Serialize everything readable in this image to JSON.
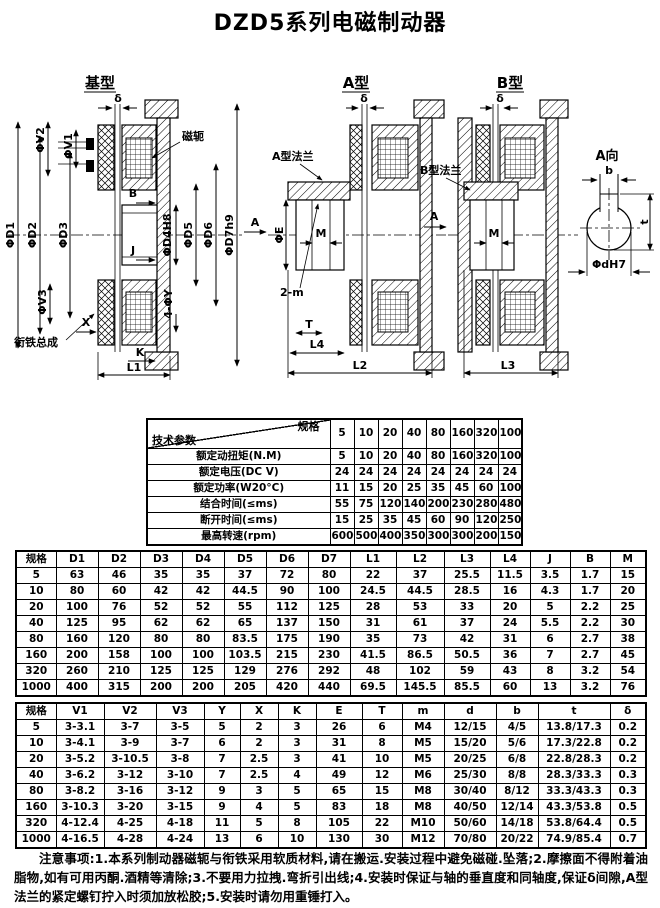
{
  "title": "DZD5系列电磁制动器",
  "diagrams": {
    "base": {
      "title": "基型",
      "delta": "δ",
      "yoke": "磁轭",
      "armature": "衔铁总成",
      "v1": "ΦV1",
      "v2": "ΦV2",
      "v3": "ΦV3",
      "d1": "ΦD1",
      "d2": "ΦD2",
      "d3": "ΦD3",
      "d4": "ΦD4H8",
      "d5": "ΦD5",
      "d6": "ΦD6",
      "d7": "ΦD7h9",
      "b": "B",
      "j": "J",
      "four_y": "4-ΦY",
      "x": "X",
      "k": "K",
      "l1": "L1"
    },
    "typeA": {
      "title": "A型",
      "delta": "δ",
      "flange": "A型法兰",
      "e": "ΦE",
      "m": "M",
      "a": "A",
      "two_m": "2-m",
      "t": "T",
      "l4": "L4",
      "l2": "L2"
    },
    "typeB": {
      "title": "B型",
      "delta": "δ",
      "flange": "B型法兰",
      "m": "M",
      "l3": "L3"
    },
    "viewA": {
      "title": "A向",
      "b": "b",
      "t": "t",
      "d": "ΦdH7"
    }
  },
  "table1": {
    "corner_top": "规格",
    "corner_bottom": "技术参数",
    "columns": [
      "5",
      "10",
      "20",
      "40",
      "80",
      "160",
      "320",
      "1000"
    ],
    "rows": [
      {
        "label": "额定动扭矩(N.M)",
        "values": [
          "5",
          "10",
          "20",
          "40",
          "80",
          "160",
          "320",
          "1000"
        ]
      },
      {
        "label": "额定电压(DC V)",
        "values": [
          "24",
          "24",
          "24",
          "24",
          "24",
          "24",
          "24",
          "24"
        ]
      },
      {
        "label": "额定功率(W20°C)",
        "values": [
          "11",
          "15",
          "20",
          "25",
          "35",
          "45",
          "60",
          "100"
        ]
      },
      {
        "label": "结合时间(≤ms)",
        "values": [
          "55",
          "75",
          "120",
          "140",
          "200",
          "230",
          "280",
          "480"
        ]
      },
      {
        "label": "断开时间(≤ms)",
        "values": [
          "15",
          "25",
          "35",
          "45",
          "60",
          "90",
          "120",
          "250"
        ]
      },
      {
        "label": "最高转速(rpm)",
        "values": [
          "6000",
          "5000",
          "4000",
          "3500",
          "3000",
          "3000",
          "2000",
          "1500"
        ]
      }
    ]
  },
  "table2": {
    "headers": [
      "规格",
      "D1",
      "D2",
      "D3",
      "D4",
      "D5",
      "D6",
      "D7",
      "L1",
      "L2",
      "L3",
      "L4",
      "J",
      "B",
      "M"
    ],
    "rows": [
      [
        "5",
        "63",
        "46",
        "35",
        "35",
        "37",
        "72",
        "80",
        "22",
        "37",
        "25.5",
        "11.5",
        "3.5",
        "1.7",
        "15"
      ],
      [
        "10",
        "80",
        "60",
        "42",
        "42",
        "44.5",
        "90",
        "100",
        "24.5",
        "44.5",
        "28.5",
        "16",
        "4.3",
        "1.7",
        "20"
      ],
      [
        "20",
        "100",
        "76",
        "52",
        "52",
        "55",
        "112",
        "125",
        "28",
        "53",
        "33",
        "20",
        "5",
        "2.2",
        "25"
      ],
      [
        "40",
        "125",
        "95",
        "62",
        "62",
        "65",
        "137",
        "150",
        "31",
        "61",
        "37",
        "24",
        "5.5",
        "2.2",
        "30"
      ],
      [
        "80",
        "160",
        "120",
        "80",
        "80",
        "83.5",
        "175",
        "190",
        "35",
        "73",
        "42",
        "31",
        "6",
        "2.7",
        "38"
      ],
      [
        "160",
        "200",
        "158",
        "100",
        "100",
        "103.5",
        "215",
        "230",
        "41.5",
        "86.5",
        "50.5",
        "36",
        "7",
        "2.7",
        "45"
      ],
      [
        "320",
        "260",
        "210",
        "125",
        "125",
        "129",
        "276",
        "292",
        "48",
        "102",
        "59",
        "43",
        "8",
        "3.2",
        "54"
      ],
      [
        "1000",
        "400",
        "315",
        "200",
        "200",
        "205",
        "420",
        "440",
        "69.5",
        "145.5",
        "85.5",
        "60",
        "13",
        "3.2",
        "76"
      ]
    ]
  },
  "table3": {
    "headers": [
      "规格",
      "V1",
      "V2",
      "V3",
      "Y",
      "X",
      "K",
      "E",
      "T",
      "m",
      "d",
      "b",
      "t",
      "δ"
    ],
    "rows": [
      [
        "5",
        "3-3.1",
        "3-7",
        "3-5",
        "5",
        "2",
        "3",
        "26",
        "6",
        "M4",
        "12/15",
        "4/5",
        "13.8/17.3",
        "0.2"
      ],
      [
        "10",
        "3-4.1",
        "3-9",
        "3-7",
        "6",
        "2",
        "3",
        "31",
        "8",
        "M5",
        "15/20",
        "5/6",
        "17.3/22.8",
        "0.2"
      ],
      [
        "20",
        "3-5.2",
        "3-10.5",
        "3-8",
        "7",
        "2.5",
        "3",
        "41",
        "10",
        "M5",
        "20/25",
        "6/8",
        "22.8/28.3",
        "0.2"
      ],
      [
        "40",
        "3-6.2",
        "3-12",
        "3-10",
        "7",
        "2.5",
        "4",
        "49",
        "12",
        "M6",
        "25/30",
        "8/8",
        "28.3/33.3",
        "0.3"
      ],
      [
        "80",
        "3-8.2",
        "3-16",
        "3-12",
        "9",
        "3",
        "5",
        "65",
        "15",
        "M8",
        "30/40",
        "8/12",
        "33.3/43.3",
        "0.3"
      ],
      [
        "160",
        "3-10.3",
        "3-20",
        "3-15",
        "9",
        "4",
        "5",
        "83",
        "18",
        "M8",
        "40/50",
        "12/14",
        "43.3/53.8",
        "0.5"
      ],
      [
        "320",
        "4-12.4",
        "4-25",
        "4-18",
        "11",
        "5",
        "8",
        "105",
        "22",
        "M10",
        "50/60",
        "14/18",
        "53.8/64.4",
        "0.5"
      ],
      [
        "1000",
        "4-16.5",
        "4-28",
        "4-24",
        "13",
        "6",
        "10",
        "130",
        "30",
        "M12",
        "70/80",
        "20/22",
        "74.9/85.4",
        "0.7"
      ]
    ]
  },
  "notes": "注意事项:1.本系列制动器磁轭与衔铁采用软质材料,请在搬运.安装过程中避免磁碰.坠落;2.摩擦面不得附着油脂物,如有可用丙酮.酒精等清除;3.不要用力拉拽.弯折引出线;4.安装时保证与轴的垂直度和同轴度,保证δ间隙,A型法兰的紧定螺钉拧入时须加放松胶;5.安装时请勿用重锤打入。"
}
